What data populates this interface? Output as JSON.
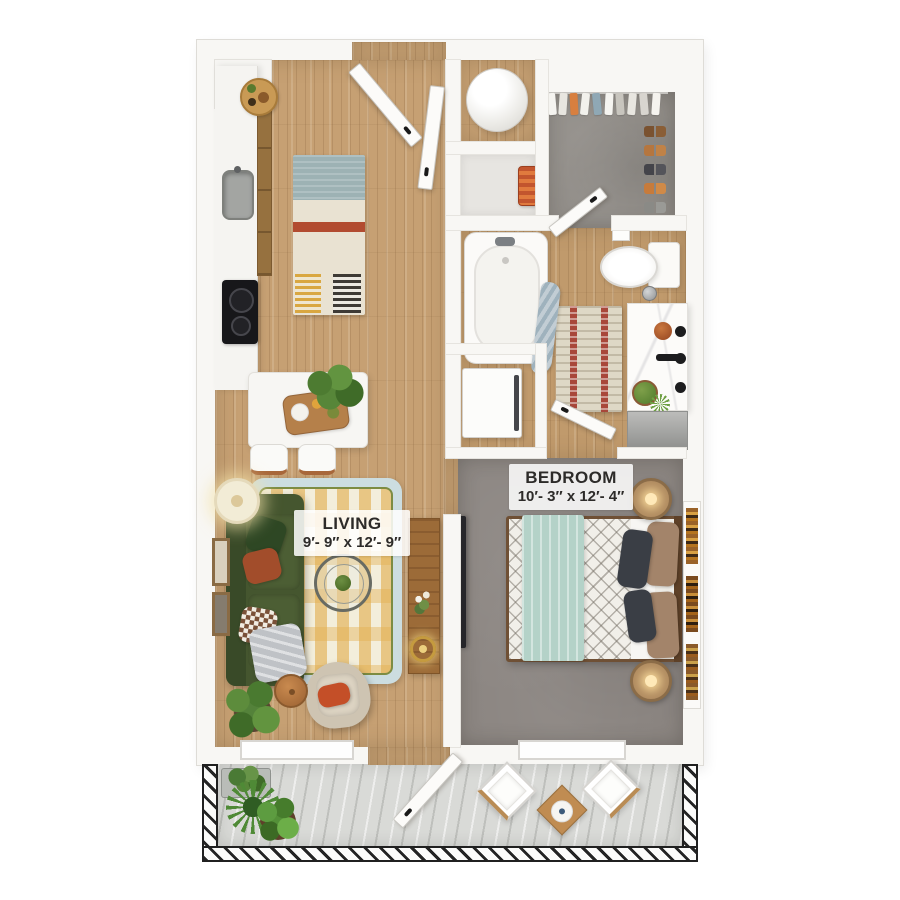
{
  "floor_plan": {
    "labels": {
      "bedroom": {
        "name": "BEDROOM",
        "dimensions": "10′- 3″ x 12′- 4″"
      },
      "living": {
        "name": "LIVING",
        "dimensions": "9′- 9″ x 12′- 9″"
      }
    },
    "rooms": [
      "kitchen",
      "living room",
      "bedroom",
      "bathroom",
      "walk-in closet",
      "laundry closet",
      "water heater closet",
      "hallway",
      "balcony"
    ],
    "colors": {
      "wall": "#f8f7f4",
      "wood_floor": "#c6a073",
      "bedroom_carpet": "#8b8581",
      "closet_carpet": "#908c87",
      "balcony_floor": "#d9dad7",
      "sofa_green": "#45562f",
      "rug_yellow": "#e2ae4e",
      "rug_border_blue": "#ccdde0",
      "bed_throw_mint": "#b4d2c8",
      "accent_rust": "#b0502c",
      "railing_black": "#242424"
    }
  }
}
